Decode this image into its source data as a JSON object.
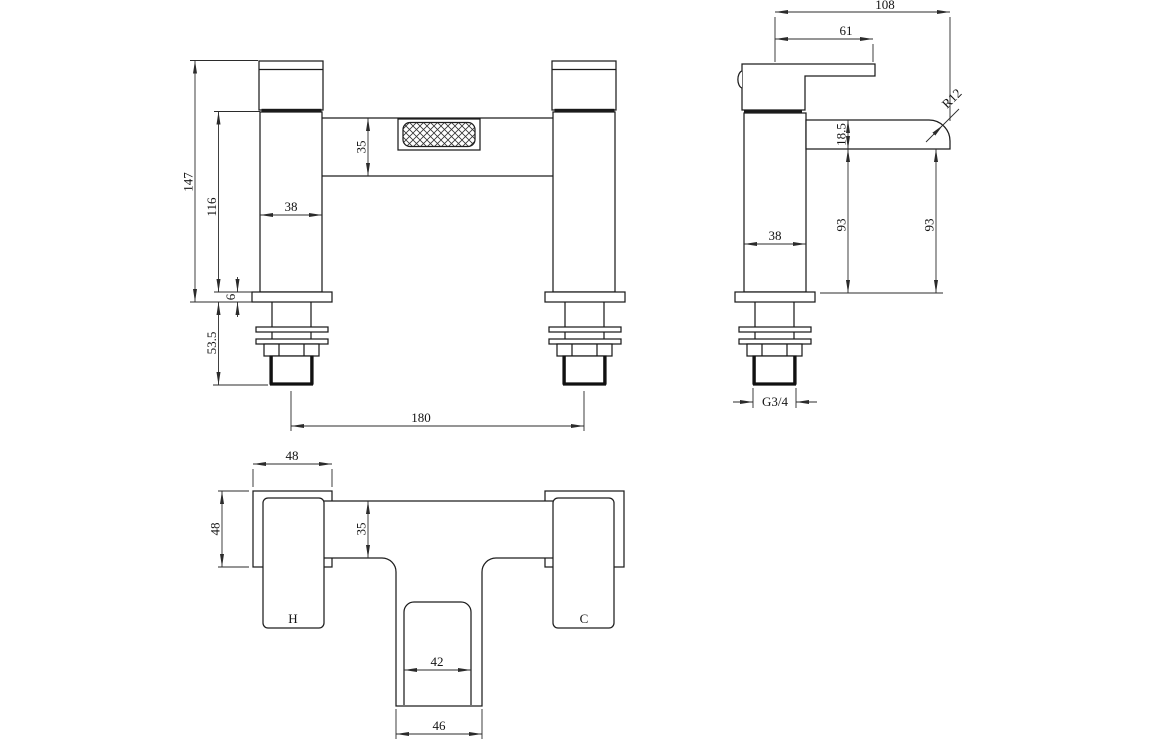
{
  "drawing": {
    "front_view": {
      "total_height": "147",
      "body_height": "116",
      "pillar_width": "38",
      "bridge_height": "35",
      "flange_thickness": "6",
      "under_deck_length": "53.5",
      "tap_centres": "180"
    },
    "side_view": {
      "total_depth": "108",
      "handle_reach": "61",
      "spout_thickness": "18.5",
      "body_to_deck": "93",
      "spout_to_deck": "93",
      "body_depth": "38",
      "spout_radius": "R12",
      "thread_size": "G3/4"
    },
    "plan_view": {
      "handle_width": "48",
      "handle_depth": "48",
      "bridge_width": "35",
      "spout_inner_width": "42",
      "spout_outer_width": "46",
      "hot_label": "H",
      "cold_label": "C"
    }
  }
}
